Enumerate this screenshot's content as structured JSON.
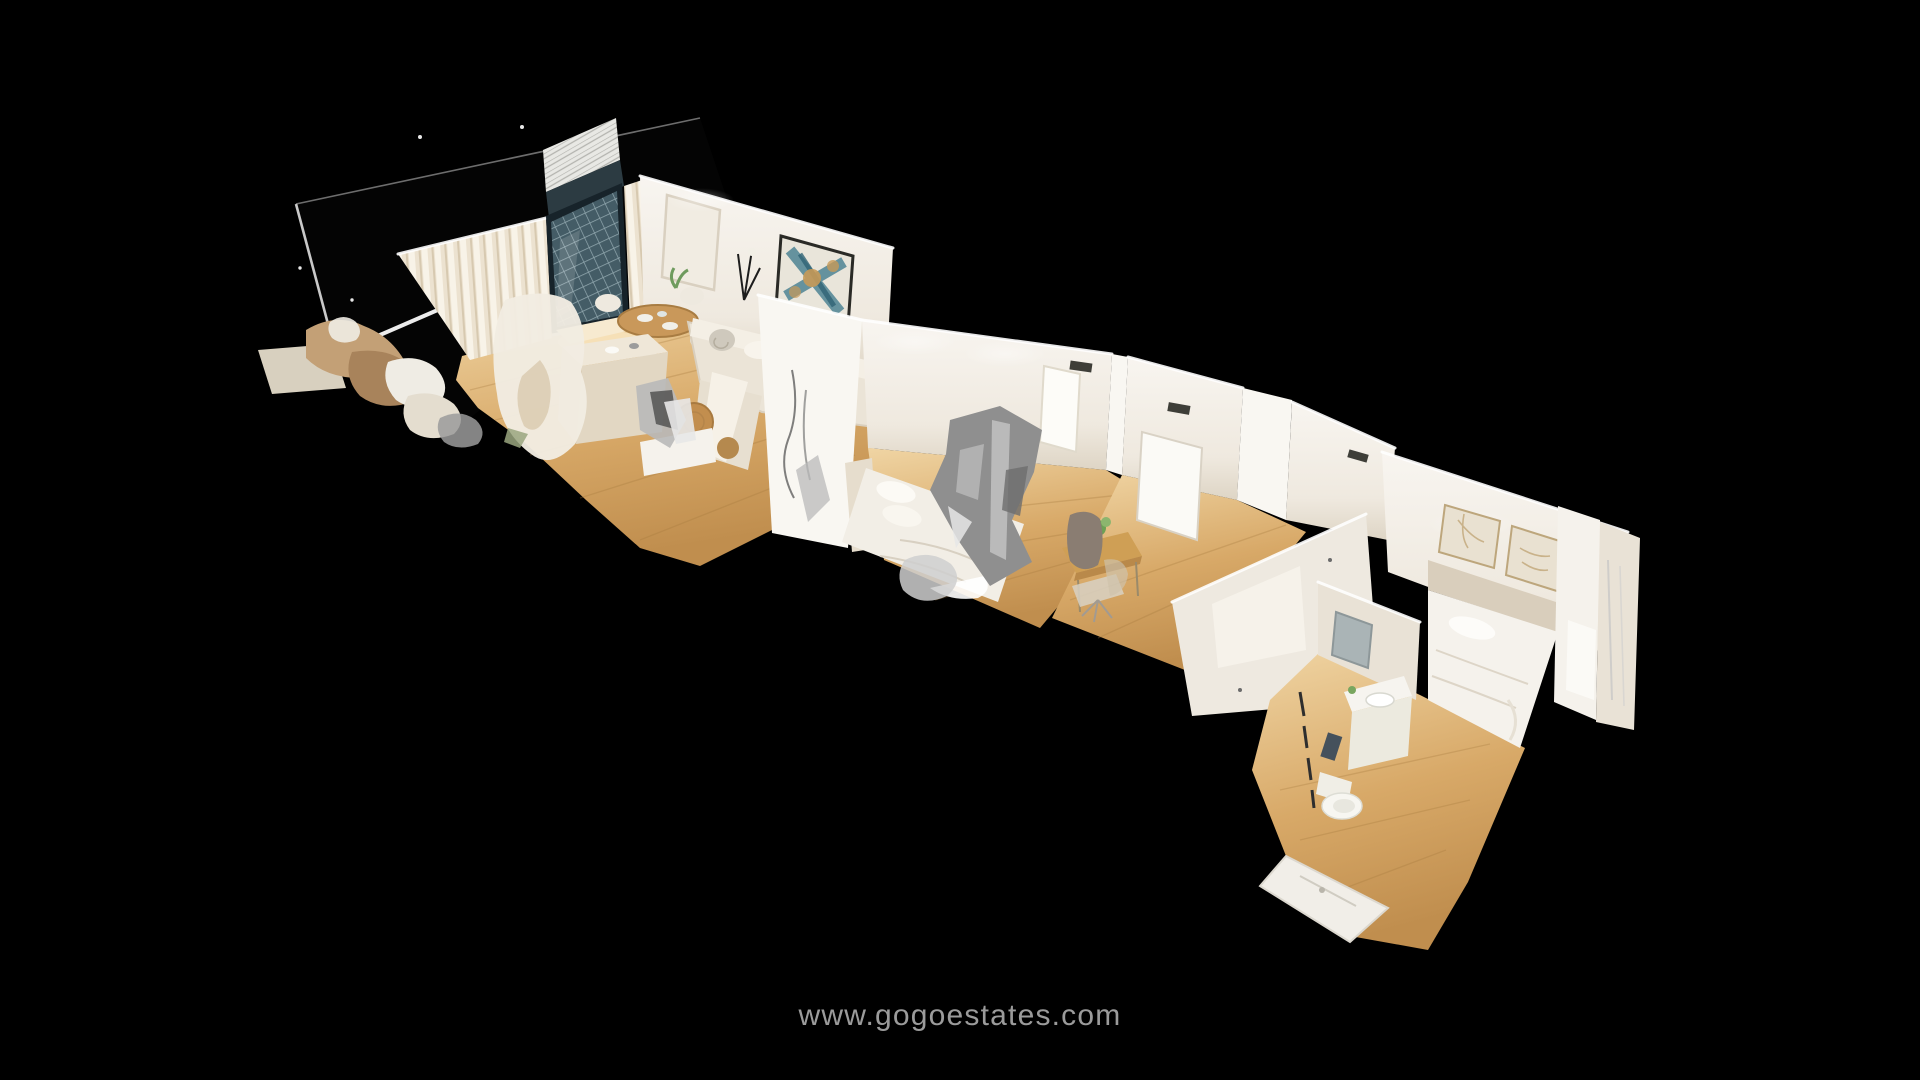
{
  "window": {
    "width": 1920,
    "height": 1080,
    "background": "#000000"
  },
  "viewer": {
    "mode": "dollhouse-3d",
    "watermark": {
      "text": "www.gogoestates.com",
      "color": "#9b9b9b"
    }
  },
  "scene": {
    "description": "Cutaway 3D dollhouse scan of a one-floor apartment seen from above at an angle on a black background",
    "rooms": [
      {
        "name": "terrace"
      },
      {
        "name": "living-dining-room"
      },
      {
        "name": "kitchen-island-area"
      },
      {
        "name": "bedroom-1"
      },
      {
        "name": "office-hallway"
      },
      {
        "name": "corridor"
      },
      {
        "name": "master-bedroom"
      },
      {
        "name": "ensuite-bathroom"
      }
    ],
    "colors": {
      "background": "#000000",
      "floor_wood": "#d8ab6c",
      "floor_wood_light": "#eed3a2",
      "wall_white": "#f3efe9",
      "wall_bright": "#fbfaf7",
      "wall_shadow": "#ddd4c6",
      "curtain": "#ece2d0",
      "balcony_glass": "#445c66",
      "glitch_gray": "#8f8f8f",
      "sofa": "#ebe4d7",
      "wood_furniture": "#c9985a",
      "painting_teal": "#4d8493",
      "painting_gold": "#c79a58",
      "bedding": "#f5f2ec"
    }
  }
}
